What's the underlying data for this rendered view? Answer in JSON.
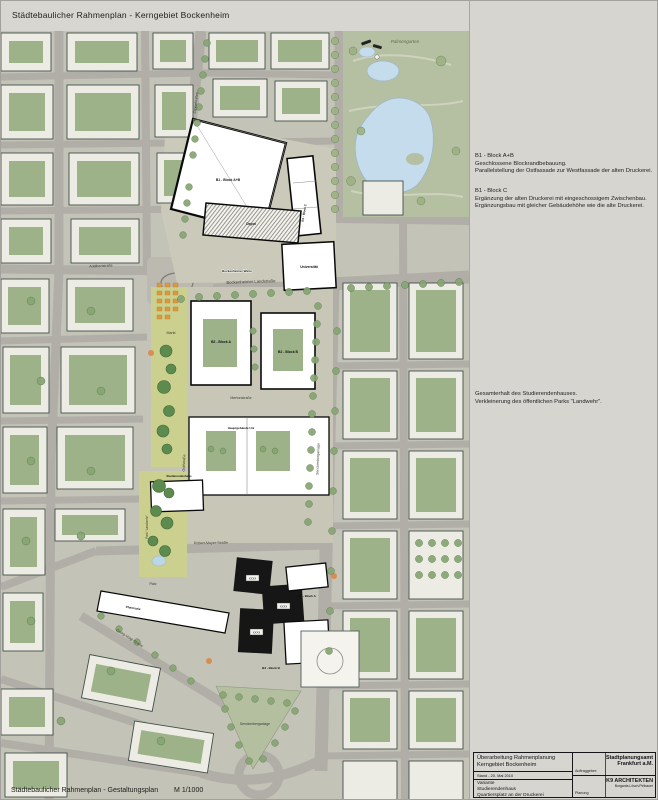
{
  "header": {
    "left_title": "Städtebaulicher Rahmenplan - Kerngebiet Bockenheim",
    "right_title": "Überarbeiteter Rahmenplan",
    "right_subtitle": "Variante"
  },
  "sidebar": {
    "notes": [
      {
        "title": "B1 - Block A+B",
        "line1": "Geschlossene Blockrandbebauung.",
        "line2": "Parallelstellung der Ostfassade zur Westfassade der alten Druckerei."
      },
      {
        "title": "B1 - Block C",
        "line1": "Ergänzung der alten Druckerei mit eingeschossigem Zwischenbau.",
        "line2": "Ergänzungsbau mit gleicher Gebäudehöhe wie die alte Druckerei."
      },
      {
        "title": "",
        "line1": "Gesamterhalt des Studierendenhauses.",
        "line2": "Verkleinerung des öffentlichen Parks \"Landwehr\"."
      }
    ]
  },
  "titleblock": {
    "project_line1": "Überarbeitung Rahmenplanung",
    "project_line2": "Kerngebiet Bockenheim",
    "date": "Stand - 20. Mai 2010",
    "variant_line1": "Variante",
    "variant_line2": "Studierendenhaus",
    "variant_line3": "Quartiersplatz an der Druckerei",
    "client_label": "Auftraggeber:",
    "client_line1": "Stadtplanungsamt",
    "client_line2": "Frankfurt a.M.",
    "planner_label": "Planung",
    "planner_line1": "K9 ARCHITEKTEN",
    "planner_line2": "Borgards.Lösch.Piribauer"
  },
  "map": {
    "caption": "Städtebaulicher Rahmenplan - Gestaltungsplan",
    "scale": "M 1/1000",
    "labels": [
      {
        "text": "Palmengarten"
      },
      {
        "text": "Bockenheimer Landstraße"
      },
      {
        "text": "Zeppelinallee"
      },
      {
        "text": "Adalbertstraße"
      },
      {
        "text": "Bockenheimer Warte"
      },
      {
        "text": "Markt"
      },
      {
        "text": "B1 - Block A+B"
      },
      {
        "text": "B1 - Block C"
      },
      {
        "text": "Depot"
      },
      {
        "text": "Universität"
      },
      {
        "text": "B2 - Block A"
      },
      {
        "text": "B2 - Block B"
      },
      {
        "text": "Mertonstraße"
      },
      {
        "text": "Gräfstraße"
      },
      {
        "text": "Hauptgebäude Uni"
      },
      {
        "text": "Park \"Landwehr\""
      },
      {
        "text": "Studierendenhaus"
      },
      {
        "text": "Senckenberganlage"
      },
      {
        "text": "Robert-Mayer-Straße"
      },
      {
        "text": "B3 - Block A"
      },
      {
        "text": "B3 - Block B"
      },
      {
        "text": "Platz"
      },
      {
        "text": "Pharmazie"
      },
      {
        "text": "Georg-Voigt-Straße"
      },
      {
        "text": "Senckenberganlage"
      },
      {
        "text": "XXXX"
      },
      {
        "text": "XXXX"
      },
      {
        "text": "XXXX"
      }
    ]
  },
  "colors": {
    "page_bg": "#d7d6d1",
    "land": "#c4c3b7",
    "street": "#b1aea7",
    "park_green": "#b5bfa2",
    "courtyard_green": "#9db288",
    "axis_green": "#ccd08e",
    "lake_blue": "#c4dcec",
    "new_building": "#ffffff",
    "tower_black": "#161616",
    "market_orange": "#dd9a3b"
  }
}
